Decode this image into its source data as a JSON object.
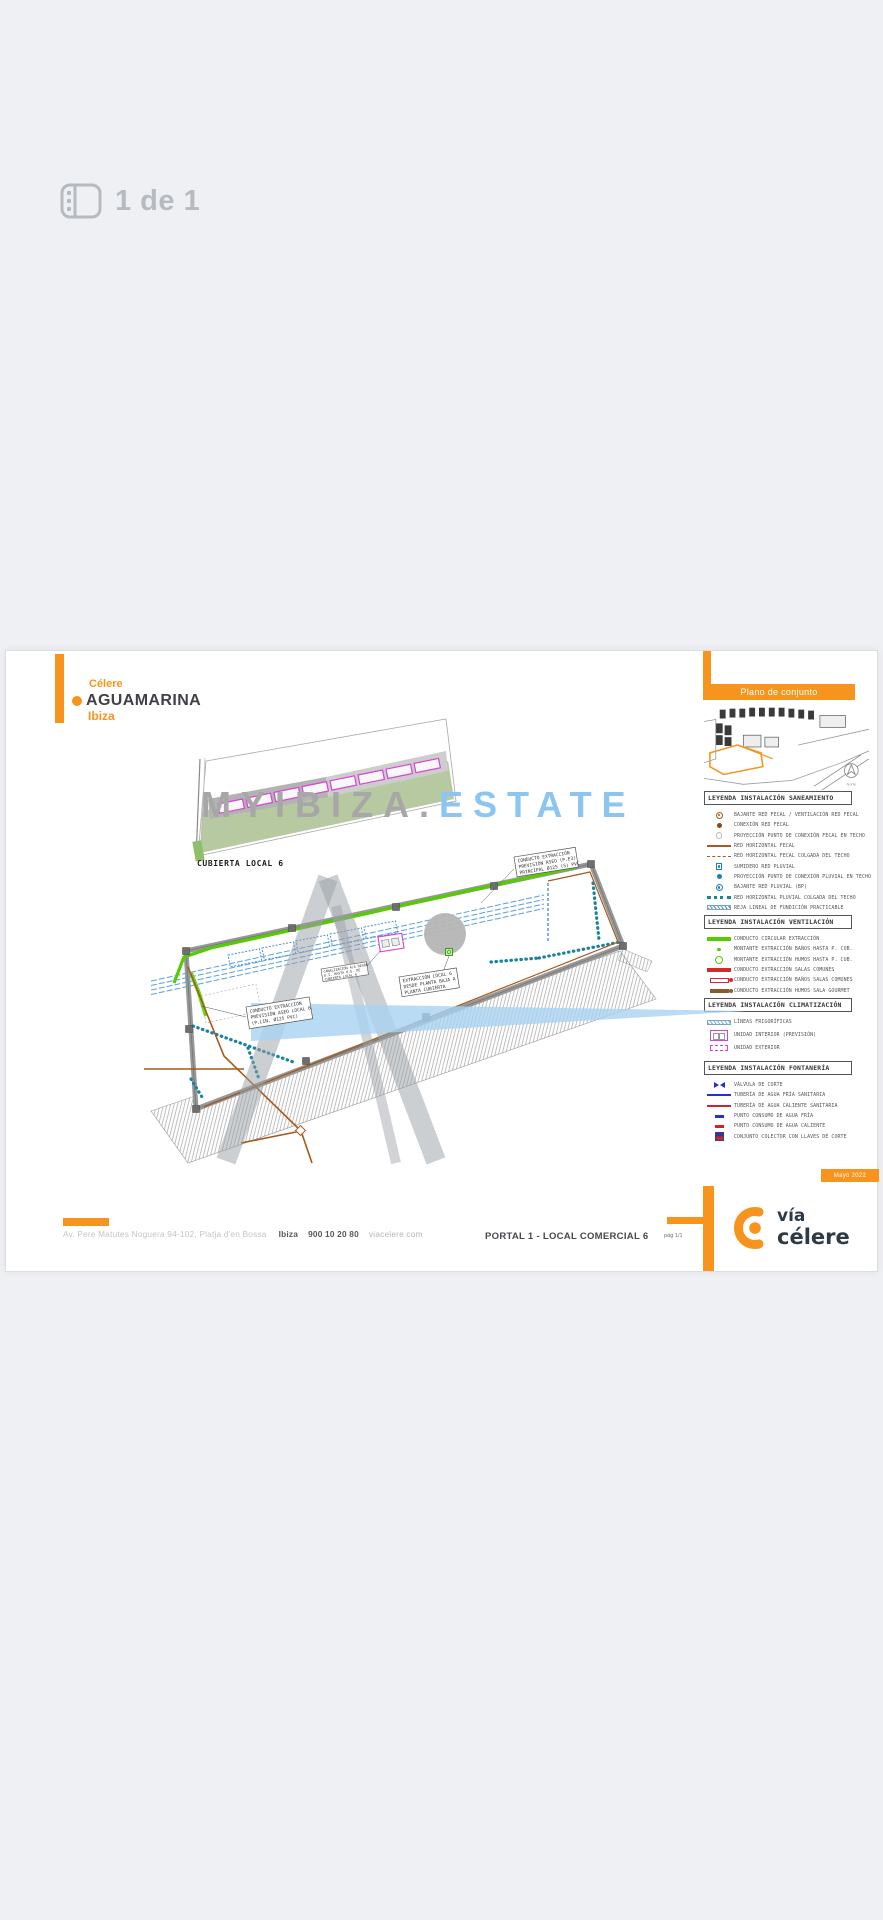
{
  "viewer": {
    "page_indicator": "1 de 1"
  },
  "doc": {
    "brand": {
      "line1": "Célere",
      "line2": "AGUAMARINA",
      "line3": "Ibiza"
    },
    "map_panel": {
      "title": "Plano de conjunto",
      "north_label": "Norte"
    },
    "legends": {
      "saneamiento": {
        "title": "LEYENDA INSTALACIÓN SANEAMIENTO",
        "items": [
          "BAJANTE RED FECAL / VENTILACIÓN RED FECAL",
          "CONEXIÓN RED FECAL",
          "PROYECCIÓN PUNTO DE CONEXIÓN FECAL EN TECHO",
          "RED HORIZONTAL FECAL",
          "RED HORIZONTAL FECAL COLGADA DEL TECHO",
          "SUMIDERO RED PLUVIAL",
          "PROYECCIÓN PUNTO DE CONEXIÓN PLUVIAL EN TECHO",
          "BAJANTE RED PLUVIAL (BP)",
          "RED HORIZONTAL PLUVIAL COLGADA DEL TECHO",
          "REJA LINEAL DE FUNDICIÓN PRACTICABLE"
        ]
      },
      "ventilacion": {
        "title": "LEYENDA INSTALACIÓN VENTILACIÓN",
        "items": [
          "CONDUCTO CIRCULAR EXTRACCIÓN",
          "MONTANTE EXTRACCIÓN BAÑOS HASTA P. CUB.",
          "MONTANTE EXTRACCIÓN HUMOS HASTA P. CUB.",
          "CONDUCTO EXTRACCIÓN SALAS COMUNES",
          "CONDUCTO EXTRACCIÓN BAÑOS SALAS COMUNES",
          "CONDUCTO EXTRACCIÓN HUMOS SALA GOURMET"
        ]
      },
      "climatizacion": {
        "title": "LEYENDA INSTALACIÓN CLIMATIZACIÓN",
        "items": [
          "LÍNEAS FRIGORÍFICAS",
          "UNIDAD INTERIOR (PREVISIÓN)",
          "UNIDAD EXTERIOR"
        ]
      },
      "fontaneria": {
        "title": "LEYENDA INSTALACIÓN FONTANERÍA",
        "items": [
          "VÁLVULA DE CORTE",
          "TUBERÍA DE AGUA FRÍA SANITARIA",
          "TUBERÍA DE AGUA CALIENTE SANITARIA",
          "PUNTO CONSUMO DE AGUA FRÍA",
          "PUNTO CONSUMO DE AGUA CALIENTE",
          "CONJUNTO COLECTOR CON LLAVES DE CORTE"
        ]
      }
    },
    "drawing": {
      "roof_label": "CUBIERTA LOCAL 6",
      "labels": {
        "l1": [
          "CONDUCTO EXTRACCIÓN",
          "PREVISIÓN ASEO LOCAL 6",
          "(P.LIN. Ø125 PVC)"
        ],
        "l2": [
          "EXTRACCIÓN LOCAL 6",
          "DESDE PLANTA BAJA A",
          "PLANTA CUBIERTA"
        ],
        "l3": [
          "CONDUCTO EXTRACCIÓN",
          "PREVISIÓN ASEO (P.E3)",
          "PRINCIPAL Ø125 (S) PVC"
        ],
        "l4": [
          "CANALIZACIÓN A/A DESDE",
          "U.I. HASTA U.E. DE",
          "CUBIERTA LOCAL 6"
        ]
      },
      "watermark": {
        "part1": "MYIBIZA.",
        "part2": "ESTATE"
      }
    },
    "footer": {
      "address": "Av. Pere Matutes Noguera 94-102, Platja d'en Bossa",
      "city": "Ibiza",
      "phone": "900 10 20 80",
      "website": "viacelere.com",
      "plan_title": "PORTAL 1 - LOCAL COMERCIAL 6",
      "page_label": "pág 1/1",
      "date_badge": "Mayo 2022",
      "logo_line1": "vía",
      "logo_line2": "célere"
    }
  },
  "colors": {
    "brand_orange": "#F7941E",
    "logo_navy": "#2E3A46",
    "watermark_gray": "#A7A7A7",
    "watermark_blue": "#8CC5F0",
    "ventilation_green": "#54CC00",
    "frigo_blue": "#4A90D9",
    "pluvial_teal": "#1A84A0",
    "fecal_brown": "#A55B1B",
    "clima_magenta": "#D840D8",
    "extract_red": "#D42A2A",
    "water_cold_blue": "#2233CC",
    "water_hot_red": "#CC2233"
  }
}
